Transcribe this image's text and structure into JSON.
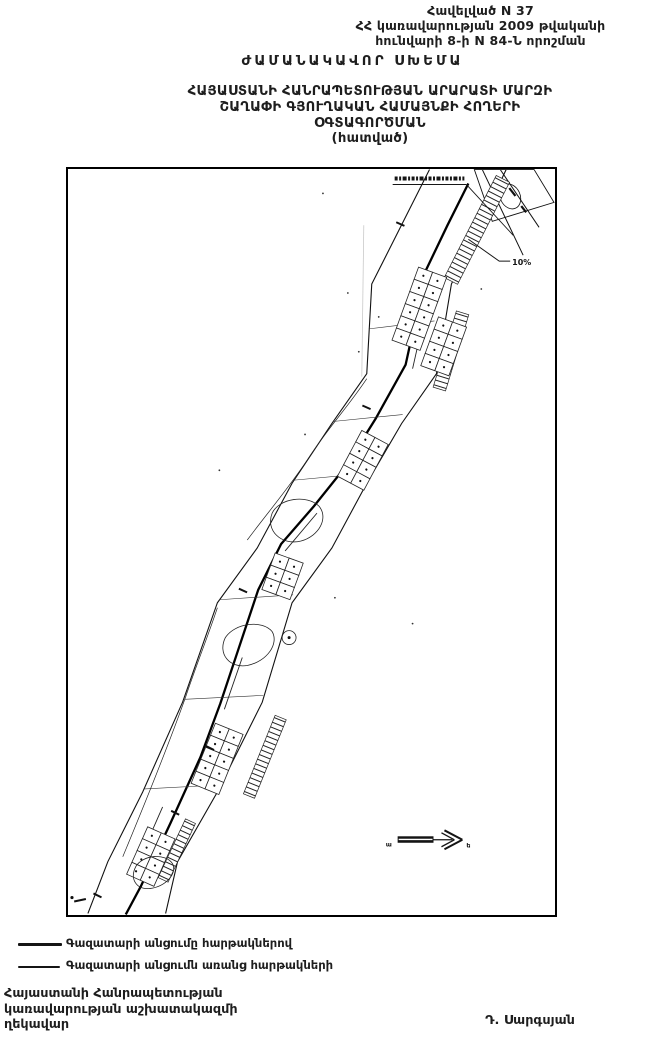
{
  "document": {
    "appendix_lines": [
      "Հավելված N 37",
      "ՀՀ կառավարության 2009 թվականի",
      "հունվարի 8-ի N 84-Ն որոշման"
    ],
    "schema_heading": "ԺԱՄԱՆԱԿԱՎՈՐ ՍԽԵՄԱ",
    "title_lines": [
      "ՀԱՅԱՍՏԱՆԻ ՀԱՆՐԱՊԵՏՈՒԹՅԱՆ ԱՐԱՐԱՏԻ ՄԱՐԶԻ",
      "ՇԱՂԱՓԻ ԳՅՈՒՂԱԿԱՆ ՀԱՄԱՅՆՔԻ ՀՈՂԵՐԻ",
      "ՕԳՏԱԳՈՐԾՄԱՆ",
      "(հատված)"
    ],
    "map": {
      "percent_label": "10%",
      "arrow_left_letter": "ա",
      "arrow_right_letter": "ե"
    },
    "legend": {
      "items": [
        {
          "style": "thick",
          "label": "Գազատարի անցումը հարթակներով"
        },
        {
          "style": "thin",
          "label": "Գազատարի անցումն առանց հարթակների"
        }
      ]
    },
    "signature": {
      "left_lines": [
        "Հայաստանի Հանրապետության",
        "կառավարության աշխատակազմի",
        "ղեկավար"
      ],
      "right_name": "Դ. Սարգսյան"
    }
  },
  "colors": {
    "ink": "#1e1e1e",
    "paper": "#ffffff"
  }
}
